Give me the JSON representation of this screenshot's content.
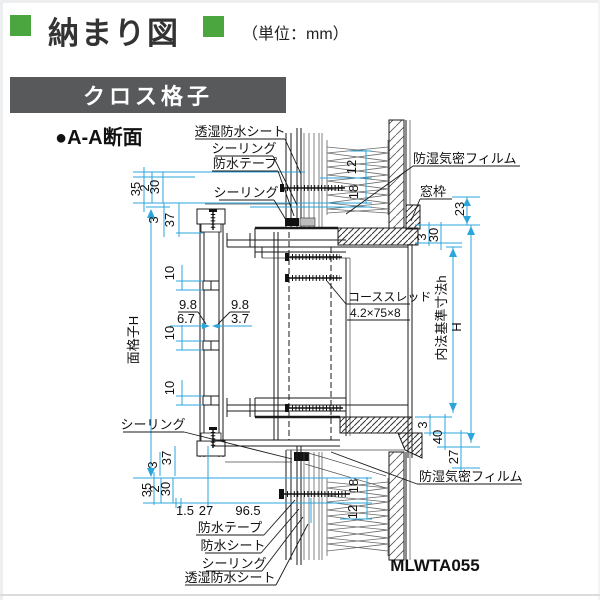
{
  "header": {
    "title": "納まり図",
    "unit_label": "（単位：mm）"
  },
  "banner": {
    "text": "クロス格子"
  },
  "section": {
    "label": "●A-A断面"
  },
  "drawing_code": "MLWTA055",
  "colors": {
    "accent_green": "#4CA63F",
    "banner_gray": "#58595B",
    "dim_line_cyan": "#2BA6DB",
    "drawing_line": "#1A1A1A"
  },
  "labels": {
    "toshitsu_top": "透湿防水シート",
    "sealing_top1": "シーリング",
    "bousui_tape_top": "防水テープ",
    "sealing_top2": "シーリング",
    "boushitsu_film_top": "防湿気密フィルム",
    "madowaku": "窓枠",
    "screw_name": "コーススレッド",
    "screw_spec": "4.2×75×8",
    "sealing_left": "シーリング",
    "bousui_tape_bottom": "防水テープ",
    "bousui_sheet_bottom": "防水シート",
    "sealing_bottom": "シーリング",
    "toshitsu_bottom": "透湿防水シート",
    "boushitsu_film_bottom": "防湿気密フィルム"
  },
  "dims": {
    "tl_35": "35",
    "tl_2": "2",
    "tl_30": "30",
    "tl_3": "3",
    "tl_37": "37",
    "lattice_height": "面格子H",
    "lat_10a": "10",
    "lat_10b": "10",
    "lat_10c": "10",
    "lat_98l": "9.8",
    "lat_67": "6.7",
    "lat_98r": "9.8",
    "lat_37": "3.7",
    "wt_12": "12",
    "wt_18": "18",
    "tr_23": "23",
    "tr_3": "3",
    "tr_30": "30",
    "inner_ref": "内法基準寸法h",
    "overall_h": "H",
    "br_3": "3",
    "br_40": "40",
    "br_27": "27",
    "wb_18": "18",
    "wb_12": "12",
    "bl_3": "3",
    "bl_37": "37",
    "bl_35": "35",
    "bl_2": "2",
    "bl_30": "30",
    "bh_15": "1.5",
    "bh_27": "27",
    "bh_965": "96.5"
  }
}
